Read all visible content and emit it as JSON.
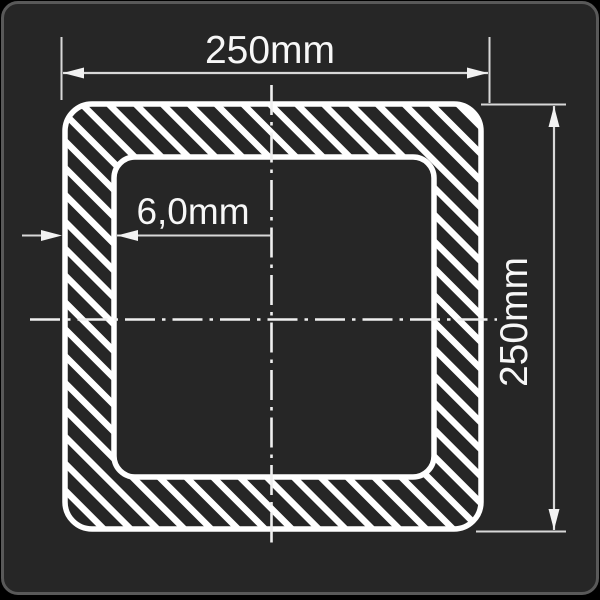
{
  "drawing": {
    "shape": "square-hollow-tube-cross-section",
    "labels": {
      "outer_width": "250mm",
      "outer_height": "250mm",
      "wall_thickness": "6,0mm"
    },
    "colors": {
      "canvas": "#000000",
      "panel_background": "#262626",
      "panel_border": "#595959",
      "outline": "#ffffff",
      "dimension_line": "#d8d8d8",
      "center_line": "#efefef",
      "text": "#f7f7f7"
    }
  }
}
